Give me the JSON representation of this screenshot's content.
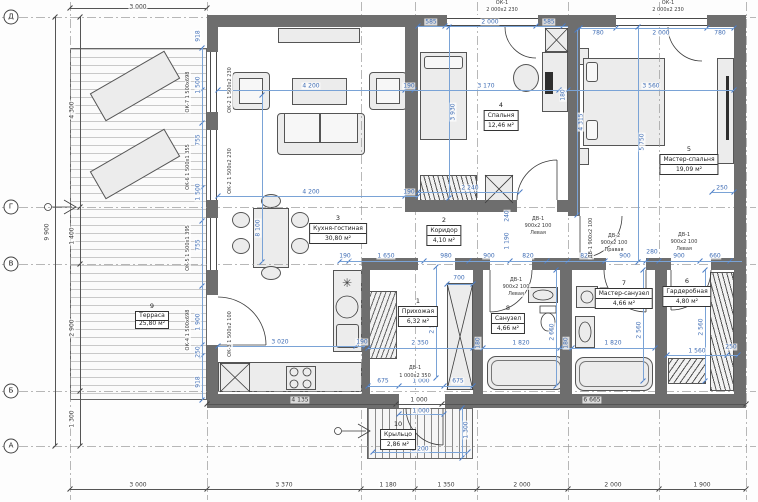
{
  "drawing": {
    "type": "floor-plan",
    "language": "ru"
  },
  "colors": {
    "wall": "#6e6e6e",
    "dim_blue": "#4a7cc7",
    "dim_black": "#444444",
    "line": "#3c3c3c"
  },
  "rooms": [
    {
      "num": "1",
      "name": "Прихожая",
      "area": "6,32 м²"
    },
    {
      "num": "2",
      "name": "Коридор",
      "area": "4,10 м²"
    },
    {
      "num": "3",
      "name": "Кухня-гостиная",
      "area": "30,80 м²"
    },
    {
      "num": "4",
      "name": "Спальня",
      "area": "12,46 м²"
    },
    {
      "num": "5",
      "name": "Мастер-спальня",
      "area": "19,09 м²"
    },
    {
      "num": "6",
      "name": "Гардеробная",
      "area": "4,80 м²"
    },
    {
      "num": "7",
      "name": "Мастер-санузел",
      "area": "4,66 м²"
    },
    {
      "num": "8",
      "name": "Санузел",
      "area": "4,66 м²"
    },
    {
      "num": "9",
      "name": "Терраса",
      "area": "25,80 м²"
    },
    {
      "num": "10",
      "name": "Крыльцо",
      "area": "2,86 м²"
    }
  ],
  "axes": {
    "h": [
      {
        "label": "Д",
        "y": 17
      },
      {
        "label": "Г",
        "y": 207
      },
      {
        "label": "В",
        "y": 264
      },
      {
        "label": "Б",
        "y": 391
      },
      {
        "label": "А",
        "y": 446
      }
    ],
    "v": [
      70,
      207,
      361,
      415,
      477,
      568,
      659,
      746
    ],
    "row_dims": [
      "4 300",
      "1 400",
      "2 900",
      "1 300"
    ],
    "total_height": "9 900",
    "col_dims": [
      "3 000",
      "3 370",
      "1 180",
      "1 350",
      "2 000",
      "2 000",
      "1 900"
    ]
  },
  "dimlines": [
    [
      70,
      8,
      207,
      8,
      "k",
      [
        70,
        207
      ]
    ],
    [
      55,
      17,
      55,
      446,
      "k",
      [
        17,
        446
      ]
    ],
    [
      80,
      17,
      80,
      446,
      "k",
      [
        17,
        207,
        264,
        391,
        446
      ]
    ],
    [
      70,
      489,
      746,
      489,
      "k",
      [
        70,
        207,
        361,
        415,
        477,
        568,
        659,
        746
      ]
    ],
    [
      207,
      404,
      746,
      404,
      "k",
      [
        207,
        396,
        442,
        746
      ]
    ],
    [
      218,
      90,
      734,
      90,
      "d",
      [
        218,
        405,
        414,
        559,
        568,
        734
      ]
    ],
    [
      218,
      196,
      418,
      196,
      "d",
      [
        218,
        405,
        418
      ]
    ],
    [
      340,
      261,
      742,
      261,
      "d",
      [
        340,
        349,
        424,
        469,
        510,
        547,
        568,
        605,
        646,
        659,
        700,
        730
      ]
    ],
    [
      368,
      348,
      655,
      348,
      "d",
      [
        368,
        473,
        483,
        560,
        572,
        655
      ]
    ],
    [
      667,
      355,
      738,
      355,
      "d",
      [
        667,
        727,
        738
      ]
    ],
    [
      368,
      386,
      473,
      386,
      "d",
      [
        368,
        399,
        444,
        473
      ]
    ],
    [
      218,
      346,
      365,
      346,
      "d",
      [
        218,
        356,
        365
      ]
    ],
    [
      418,
      26,
      568,
      26,
      "d",
      [
        418,
        445,
        536,
        563
      ]
    ],
    [
      580,
      28,
      734,
      28,
      "d",
      [
        580,
        616,
        707,
        734
      ]
    ],
    [
      202,
      48,
      202,
      400,
      "d",
      [
        48,
        90,
        123,
        188,
        221,
        286,
        345,
        356,
        400
      ]
    ],
    [
      262,
      95,
      262,
      262,
      "d",
      [
        95,
        262
      ]
    ],
    [
      449,
      27,
      449,
      198,
      "d",
      [
        27,
        198
      ]
    ],
    [
      577,
      30,
      577,
      215,
      "d",
      [
        30,
        215
      ]
    ],
    [
      638,
      27,
      638,
      262,
      "d",
      [
        27,
        262
      ]
    ],
    [
      436,
      267,
      436,
      378,
      "d",
      [
        267,
        378
      ]
    ],
    [
      556,
      270,
      556,
      386,
      "d",
      [
        270,
        386
      ]
    ],
    [
      643,
      270,
      643,
      381,
      "d",
      [
        270,
        381
      ]
    ],
    [
      705,
      270,
      705,
      381,
      "d",
      [
        270,
        381
      ]
    ],
    [
      418,
      192,
      520,
      192,
      "d",
      [
        418,
        520
      ]
    ],
    [
      447,
      284,
      473,
      284,
      "d",
      [
        447,
        473
      ]
    ],
    [
      712,
      192,
      734,
      192,
      "d",
      [
        712,
        734
      ]
    ],
    [
      399,
      414,
      444,
      414,
      "d",
      [
        399,
        444
      ]
    ],
    [
      462,
      408,
      462,
      458,
      "d",
      [
        408,
        458
      ]
    ],
    [
      373,
      452,
      468,
      452,
      "d",
      [
        373,
        468
      ]
    ]
  ],
  "annotations": [
    {
      "t": "3 000",
      "x": 138,
      "y": 7,
      "c": "k"
    },
    {
      "t": "9 900",
      "x": 47,
      "y": 232,
      "c": "k",
      "r": 1
    },
    {
      "t": "4 300",
      "x": 72,
      "y": 110,
      "c": "k",
      "r": 1
    },
    {
      "t": "1 400",
      "x": 72,
      "y": 236,
      "c": "k",
      "r": 1
    },
    {
      "t": "2 900",
      "x": 72,
      "y": 328,
      "c": "k",
      "r": 1
    },
    {
      "t": "1 300",
      "x": 72,
      "y": 419,
      "c": "k",
      "r": 1
    },
    {
      "t": "3 000",
      "x": 138,
      "y": 485,
      "c": "k"
    },
    {
      "t": "3 370",
      "x": 284,
      "y": 485,
      "c": "k"
    },
    {
      "t": "1 180",
      "x": 388,
      "y": 485,
      "c": "k"
    },
    {
      "t": "1 350",
      "x": 446,
      "y": 485,
      "c": "k"
    },
    {
      "t": "2 000",
      "x": 522,
      "y": 485,
      "c": "k"
    },
    {
      "t": "2 000",
      "x": 613,
      "y": 485,
      "c": "k"
    },
    {
      "t": "1 900",
      "x": 702,
      "y": 485,
      "c": "k"
    },
    {
      "t": "4 135",
      "x": 300,
      "y": 400,
      "c": "k"
    },
    {
      "t": "1 000",
      "x": 419,
      "y": 400,
      "c": "k"
    },
    {
      "t": "6 665",
      "x": 592,
      "y": 400,
      "c": "k"
    },
    {
      "t": "585",
      "x": 431,
      "y": 22,
      "c": "d"
    },
    {
      "t": "2 000",
      "x": 490,
      "y": 22,
      "c": "d"
    },
    {
      "t": "585",
      "x": 549,
      "y": 22,
      "c": "d"
    },
    {
      "t": "780",
      "x": 598,
      "y": 33,
      "c": "d"
    },
    {
      "t": "2 000",
      "x": 661,
      "y": 33,
      "c": "d"
    },
    {
      "t": "780",
      "x": 720,
      "y": 33,
      "c": "d"
    },
    {
      "t": "4 200",
      "x": 311,
      "y": 86,
      "c": "d"
    },
    {
      "t": "190",
      "x": 409,
      "y": 86,
      "c": "d"
    },
    {
      "t": "3 170",
      "x": 486,
      "y": 86,
      "c": "d"
    },
    {
      "t": "180",
      "x": 563,
      "y": 95,
      "c": "d",
      "r": 1
    },
    {
      "t": "3 560",
      "x": 651,
      "y": 86,
      "c": "d"
    },
    {
      "t": "3 930",
      "x": 453,
      "y": 112,
      "c": "d",
      "r": 1
    },
    {
      "t": "4 315",
      "x": 581,
      "y": 122,
      "c": "d",
      "r": 1
    },
    {
      "t": "5 750",
      "x": 642,
      "y": 142,
      "c": "d",
      "r": 1
    },
    {
      "t": "8 100",
      "x": 258,
      "y": 228,
      "c": "d",
      "r": 1
    },
    {
      "t": "4 200",
      "x": 311,
      "y": 192,
      "c": "d"
    },
    {
      "t": "190",
      "x": 409,
      "y": 192,
      "c": "d"
    },
    {
      "t": "2 240",
      "x": 470,
      "y": 188,
      "c": "d"
    },
    {
      "t": "190",
      "x": 345,
      "y": 256,
      "c": "d"
    },
    {
      "t": "1 650",
      "x": 386,
      "y": 256,
      "c": "d"
    },
    {
      "t": "980",
      "x": 446,
      "y": 256,
      "c": "d"
    },
    {
      "t": "900",
      "x": 489,
      "y": 256,
      "c": "d"
    },
    {
      "t": "820",
      "x": 528,
      "y": 256,
      "c": "d"
    },
    {
      "t": "820",
      "x": 586,
      "y": 256,
      "c": "d"
    },
    {
      "t": "900",
      "x": 625,
      "y": 256,
      "c": "d"
    },
    {
      "t": "280",
      "x": 652,
      "y": 252,
      "c": "d"
    },
    {
      "t": "900",
      "x": 679,
      "y": 256,
      "c": "d"
    },
    {
      "t": "660",
      "x": 715,
      "y": 256,
      "c": "d"
    },
    {
      "t": "240",
      "x": 507,
      "y": 216,
      "c": "d",
      "r": 1
    },
    {
      "t": "1 190",
      "x": 507,
      "y": 241,
      "c": "d",
      "r": 1
    },
    {
      "t": "700",
      "x": 459,
      "y": 278,
      "c": "d"
    },
    {
      "t": "2 560",
      "x": 432,
      "y": 325,
      "c": "d",
      "r": 1
    },
    {
      "t": "2 660",
      "x": 552,
      "y": 332,
      "c": "d",
      "r": 1
    },
    {
      "t": "2 560",
      "x": 639,
      "y": 330,
      "c": "d",
      "r": 1
    },
    {
      "t": "2 560",
      "x": 701,
      "y": 327,
      "c": "d",
      "r": 1
    },
    {
      "t": "2 350",
      "x": 420,
      "y": 343,
      "c": "d"
    },
    {
      "t": "180",
      "x": 478,
      "y": 343,
      "c": "d",
      "r": 1
    },
    {
      "t": "1 820",
      "x": 521,
      "y": 343,
      "c": "d"
    },
    {
      "t": "180",
      "x": 566,
      "y": 343,
      "c": "d",
      "r": 1
    },
    {
      "t": "1 820",
      "x": 613,
      "y": 343,
      "c": "d"
    },
    {
      "t": "1 560",
      "x": 697,
      "y": 351,
      "c": "d"
    },
    {
      "t": "250",
      "x": 731,
      "y": 347,
      "c": "d"
    },
    {
      "t": "675",
      "x": 383,
      "y": 381,
      "c": "d"
    },
    {
      "t": "1 000",
      "x": 421,
      "y": 381,
      "c": "d"
    },
    {
      "t": "675",
      "x": 458,
      "y": 381,
      "c": "d"
    },
    {
      "t": "3 020",
      "x": 280,
      "y": 342,
      "c": "d"
    },
    {
      "t": "190",
      "x": 362,
      "y": 342,
      "c": "d"
    },
    {
      "t": "250",
      "x": 722,
      "y": 188,
      "c": "d"
    },
    {
      "t": "1 000",
      "x": 421,
      "y": 411,
      "c": "d"
    },
    {
      "t": "1 300",
      "x": 466,
      "y": 430,
      "c": "d",
      "r": 1
    },
    {
      "t": "2 200",
      "x": 420,
      "y": 449,
      "c": "d"
    },
    {
      "t": "918",
      "x": 198,
      "y": 36,
      "c": "d",
      "r": 1
    },
    {
      "t": "1 500",
      "x": 198,
      "y": 85,
      "c": "d",
      "r": 1
    },
    {
      "t": "755",
      "x": 198,
      "y": 140,
      "c": "d",
      "r": 1
    },
    {
      "t": "1 500",
      "x": 198,
      "y": 192,
      "c": "d",
      "r": 1
    },
    {
      "t": "755",
      "x": 198,
      "y": 245,
      "c": "d",
      "r": 1
    },
    {
      "t": "1 900",
      "x": 198,
      "y": 322,
      "c": "d",
      "r": 1
    },
    {
      "t": "250",
      "x": 198,
      "y": 352,
      "c": "d",
      "r": 1
    },
    {
      "t": "918",
      "x": 198,
      "y": 382,
      "c": "d",
      "r": 1
    },
    {
      "t": "ОК-1",
      "x": 502,
      "y": 3,
      "c": "t"
    },
    {
      "t": "2 000х2 230",
      "x": 502,
      "y": 10,
      "c": "t"
    },
    {
      "t": "ОК-1",
      "x": 668,
      "y": 3,
      "c": "t"
    },
    {
      "t": "2 000х2 230",
      "x": 668,
      "y": 10,
      "c": "t"
    },
    {
      "t": "ОК-2 1 500х2 230",
      "x": 230,
      "y": 90,
      "c": "t",
      "r": 1
    },
    {
      "t": "ОК-2 1 500х2 230",
      "x": 230,
      "y": 171,
      "c": "t",
      "r": 1
    },
    {
      "t": "ОК-3 1 500х2 100",
      "x": 230,
      "y": 334,
      "c": "t",
      "r": 1
    },
    {
      "t": "ОК-7 1 500х698",
      "x": 188,
      "y": 92,
      "c": "t",
      "r": 1
    },
    {
      "t": "ОК-6 1 500х1 355",
      "x": 188,
      "y": 167,
      "c": "t",
      "r": 1
    },
    {
      "t": "ОК-5 1 500х1 395",
      "x": 188,
      "y": 248,
      "c": "t",
      "r": 1
    },
    {
      "t": "ОК-4 1 500х698",
      "x": 188,
      "y": 330,
      "c": "t",
      "r": 1
    },
    {
      "t": "ДВ-1",
      "x": 538,
      "y": 219,
      "c": "t"
    },
    {
      "t": "900х2 100",
      "x": 538,
      "y": 226,
      "c": "t"
    },
    {
      "t": "Левая",
      "x": 538,
      "y": 233,
      "c": "t"
    },
    {
      "t": "ДВ-2",
      "x": 614,
      "y": 236,
      "c": "t"
    },
    {
      "t": "900х2 100",
      "x": 614,
      "y": 243,
      "c": "t"
    },
    {
      "t": "Правая",
      "x": 614,
      "y": 250,
      "c": "t"
    },
    {
      "t": "ДВ-1",
      "x": 684,
      "y": 235,
      "c": "t"
    },
    {
      "t": "900х2 100",
      "x": 684,
      "y": 242,
      "c": "t"
    },
    {
      "t": "Левая",
      "x": 684,
      "y": 249,
      "c": "t"
    },
    {
      "t": "ДВ-1",
      "x": 516,
      "y": 280,
      "c": "t"
    },
    {
      "t": "900х2 100",
      "x": 516,
      "y": 287,
      "c": "t"
    },
    {
      "t": "Левая",
      "x": 516,
      "y": 294,
      "c": "t"
    },
    {
      "t": "ДВ-1 900х2 100",
      "x": 591,
      "y": 238,
      "c": "t",
      "r": 1
    },
    {
      "t": "ДВ-1",
      "x": 415,
      "y": 368,
      "c": "t"
    },
    {
      "t": "1 000х2 350",
      "x": 415,
      "y": 376,
      "c": "t"
    }
  ]
}
